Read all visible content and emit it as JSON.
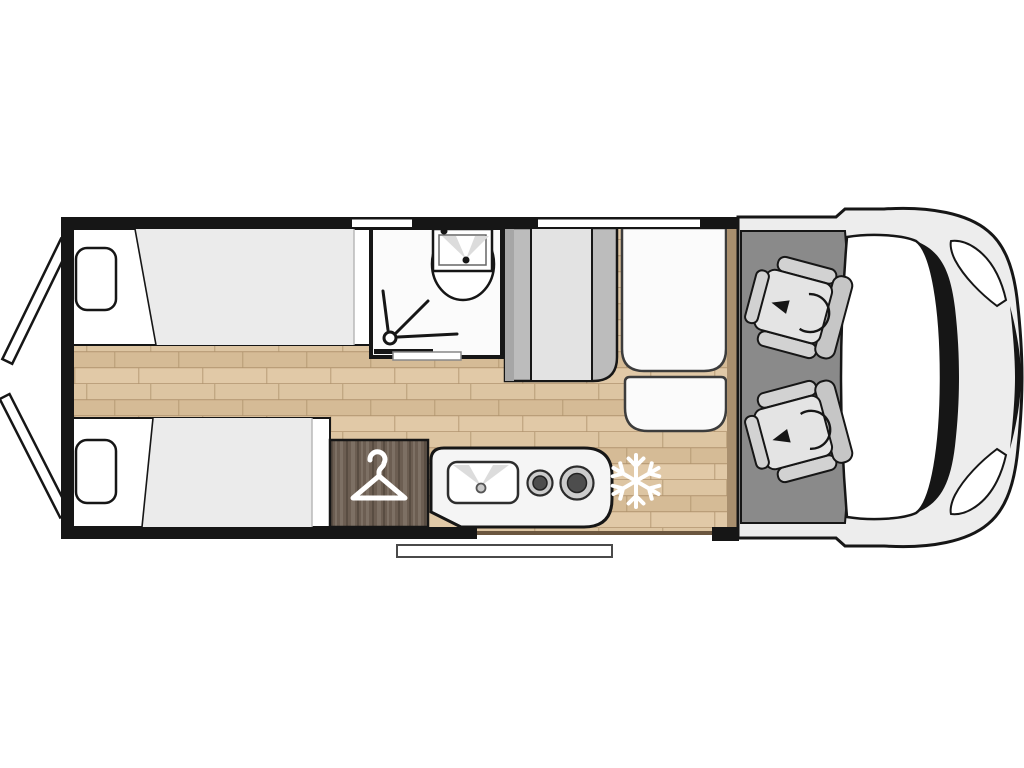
{
  "meta": {
    "title": "Campervan motorhome floor plan, top view",
    "type": "floorplan",
    "orientation": "vehicle front on the right, rear doors on the left"
  },
  "rooms": [
    {
      "name": "rear-bedroom",
      "features": [
        "twin single beds",
        "two pillows",
        "open rear barn doors"
      ]
    },
    {
      "name": "bathroom",
      "features": [
        "washbasin with cabinet",
        "shower spray symbol",
        "sliding door"
      ]
    },
    {
      "name": "wardrobe",
      "features": [
        "clothes hanger symbol"
      ]
    },
    {
      "name": "kitchen",
      "features": [
        "sink with drain",
        "two burner hob"
      ]
    },
    {
      "name": "dinette",
      "features": [
        "upholstered bench",
        "white table seat",
        "side seat"
      ]
    },
    {
      "name": "fridge-position",
      "features": [
        "snowflake symbol on floor"
      ]
    },
    {
      "name": "cab",
      "features": [
        "two swivel captain seats with rotation arrows",
        "windshield",
        "headlights",
        "entry step outside"
      ]
    }
  ],
  "icons": [
    "hanger-icon",
    "snowflake-icon",
    "shower-spray-icon",
    "swivel-arrow-icon"
  ],
  "colors": {
    "line": "#161616",
    "white": "#ffffff",
    "body": "#ededed",
    "cabfloor": "#8a8a8a",
    "seat_light": "#e4e4e4",
    "seat_mid": "#d2d2d2",
    "seat_dark": "#c6c6c6",
    "wood_a": "#ddc5a2",
    "wood_b": "#d5bb96",
    "wood_c": "#e1c9a7",
    "wood_seam": "#b1946e",
    "darkwood_base": "#6c5e52",
    "darkwood_light": "#7d7064",
    "darkwood_dark": "#594d42",
    "duvet": "#ebebeb",
    "bench_gray": "#bcbcbc",
    "bench_dark": "#a6a6a6",
    "bench_light": "#e3e3e3",
    "furniture_white": "#fbfbfb",
    "counter": "#f5f5f5",
    "trim_brown": "#a98f6e",
    "trim_dark": "#6b563f",
    "hob_ring": "#cccccc",
    "hob_center": "#4d4d4d",
    "shadow_gray": "#dcdcdc"
  }
}
